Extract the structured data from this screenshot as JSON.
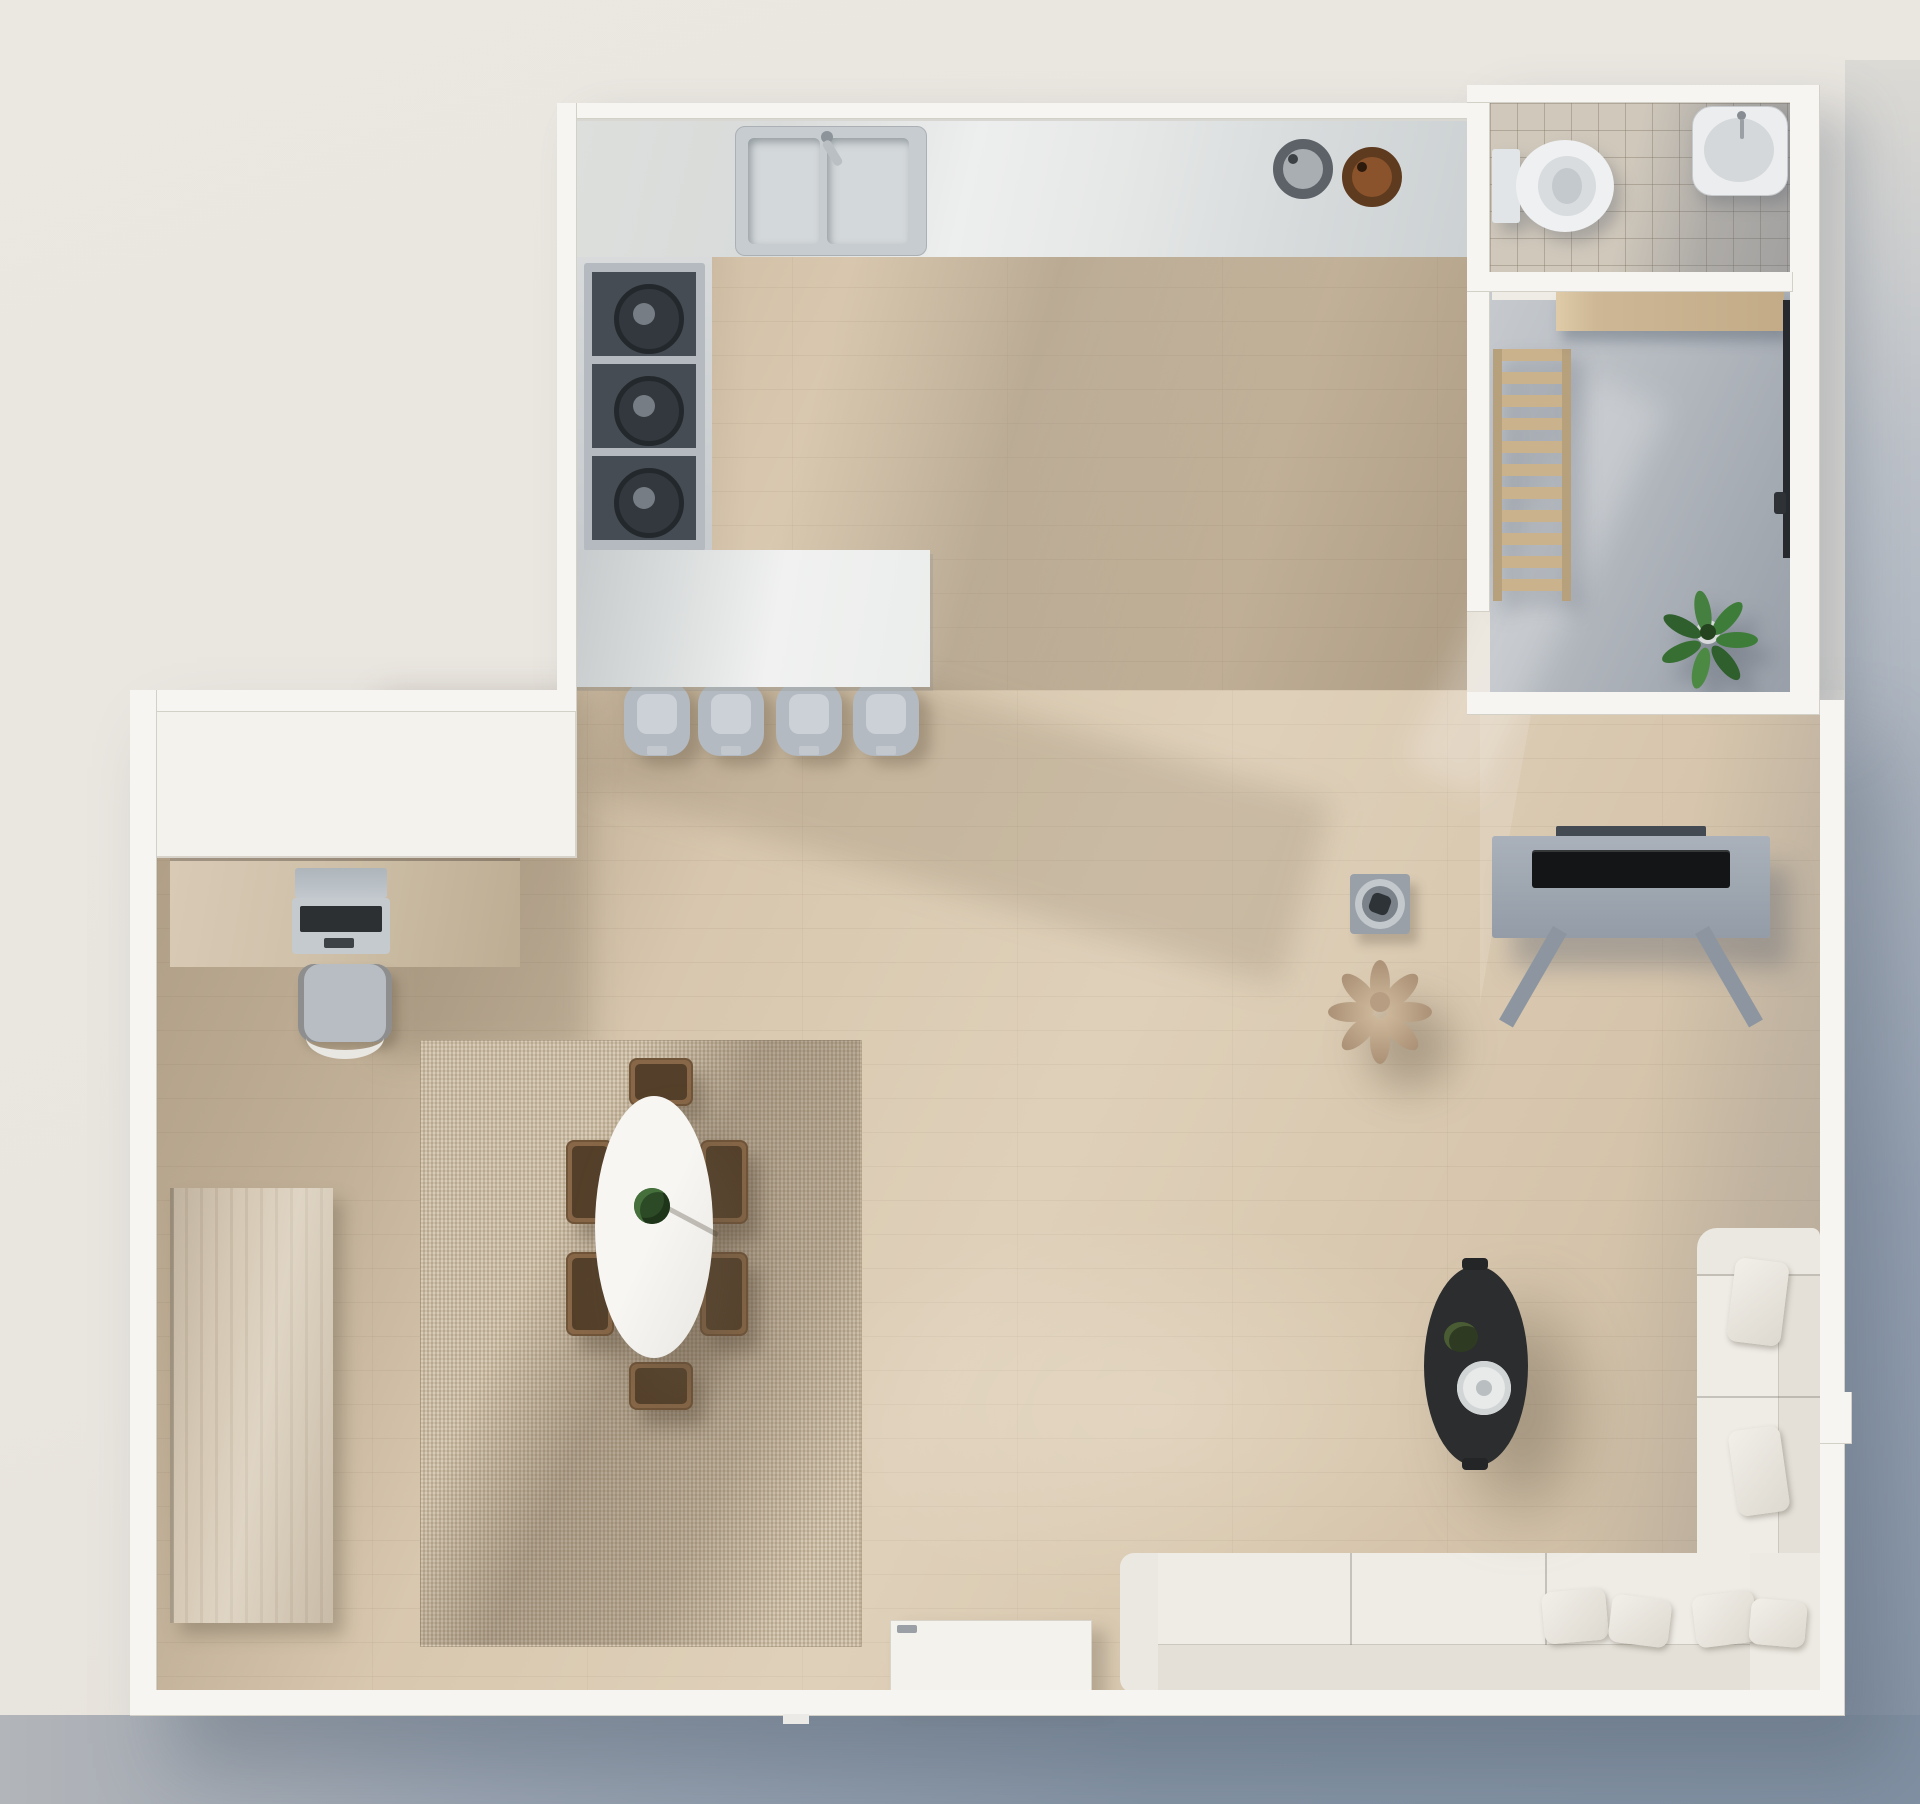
{
  "scene": {
    "kind": "architectural floor plan",
    "render_style": "photorealistic top-down 3D render",
    "lighting": "sunlight from upper left casting long diagonal shadows",
    "background_color": "#eae6e0",
    "backdrop_shadow_color": "#8593a5"
  },
  "palette": {
    "wall": "#f7f5f1",
    "wood_floor": "#d8c7ae",
    "marble_counter": "#e6e8e7",
    "rug": "#c9baa1",
    "sofa": "#efece6",
    "coffee_table": "#2b2d2e",
    "balcony_concrete": "#b6bbc1",
    "bathroom_tile": "#d0c8bb",
    "plant_green": "#3e7d39",
    "furniture_wood": "#c9b28c",
    "appliance_gray": "#b4bac0"
  },
  "rooms": [
    {
      "id": "kitchen",
      "label": "Kitchen",
      "items": [
        "L-shaped marble counter",
        "double sink with faucet",
        "gray round trivet",
        "copper round trivet",
        "three-burner cooktop",
        "marble island breakfast bar",
        "four bar stools"
      ]
    },
    {
      "id": "bathroom",
      "label": "Bathroom",
      "items": [
        "toilet",
        "washbasin with faucet",
        "beige tiled floor",
        "door threshold"
      ]
    },
    {
      "id": "balcony",
      "label": "Utility balcony",
      "items": [
        "wooden ladder shelf",
        "wooden wall shelf",
        "potted green plant",
        "dark sliding door track",
        "concrete floor"
      ]
    },
    {
      "id": "office-nook",
      "label": "Office nook",
      "items": [
        "white built-in cabinet",
        "wooden desk",
        "open laptop",
        "desk chair"
      ]
    },
    {
      "id": "living-dining",
      "label": "Living and dining room",
      "items": [
        "square woven rug",
        "white oval dining table",
        "six wooden dining chairs",
        "table centerpiece plant",
        "tall wooden wardrobe",
        "white credenza",
        "L-shaped white sectional sofa",
        "six scatter pillows",
        "black oval coffee table",
        "round serving tray",
        "flower-shaped pouf",
        "decorative bowl on square base",
        "media console with TV"
      ]
    }
  ],
  "counts": {
    "bar_stools": 4,
    "cooktop_burners": 3,
    "dining_chairs": 6,
    "sofa_pillows": 6,
    "sink_basins": 2,
    "plants": 3
  }
}
